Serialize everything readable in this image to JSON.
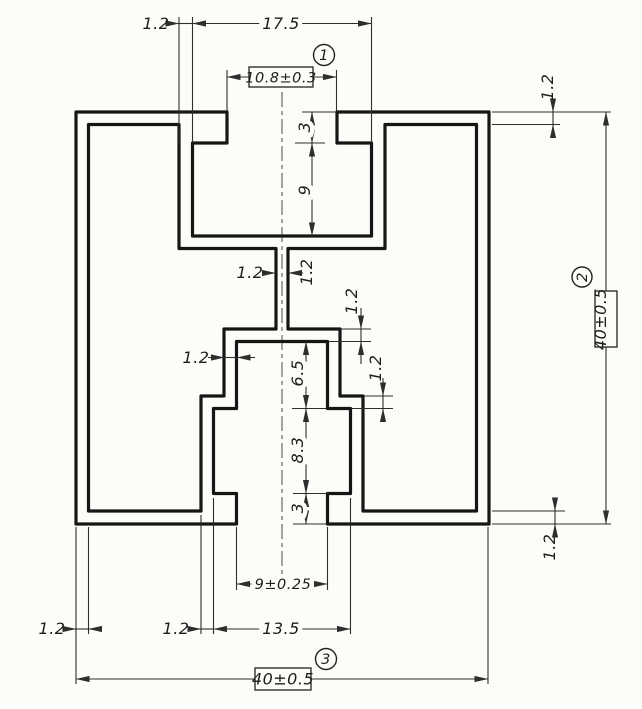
{
  "drawing": {
    "type": "technical-cross-section",
    "background_color": "#fcfcf9",
    "line_color": "#161616",
    "dims": {
      "top_left_wall": "1.2",
      "top_cavity_width": "17.5",
      "top_opening_width": "10.8±0.3",
      "top_opening_depth": "3",
      "top_cavity_depth": "9",
      "web_left": "1.2",
      "web_right": "1.2",
      "lower_top_wall": "1.2",
      "lower_step_wall": "1.2",
      "lower_side_wall": "1.2",
      "lower_upper_height": "6.5",
      "lower_mid_height": "8.3",
      "lower_opening_depth": "3",
      "left_wall": "1.2",
      "lower_outer_wall": "1.2",
      "lower_cavity_width": "13.5",
      "lower_opening_width": "9±0.25",
      "overall_width": "40±0.5",
      "overall_height": "40±0.5",
      "top_wall_right": "1.2",
      "bottom_wall_right": "1.2"
    },
    "callouts": {
      "one": "1",
      "two": "2",
      "three": "3"
    }
  }
}
